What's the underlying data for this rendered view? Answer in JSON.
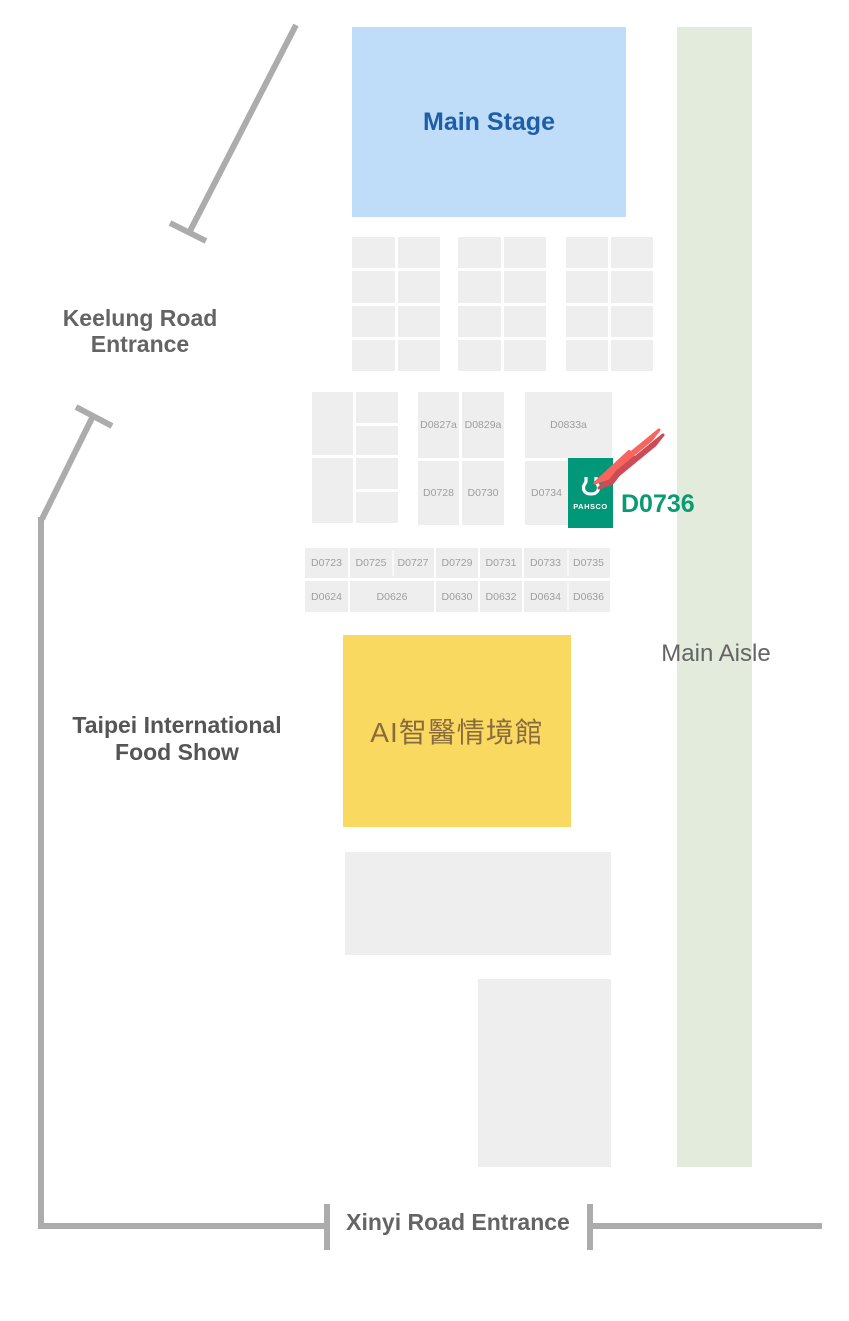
{
  "stage": {
    "label": "Main Stage"
  },
  "aisle": {
    "label": "Main Aisle"
  },
  "entrances": {
    "keelung_line1": "Keelung Road",
    "keelung_line2": "Entrance",
    "xinyi": "Xinyi Road Entrance"
  },
  "areas": {
    "food_show_line1": "Taipei International",
    "food_show_line2": "Food Show",
    "pavilion": "AI智醫情境館"
  },
  "booths": {
    "middle_top": [
      "D0827a",
      "D0829a",
      "D0833a"
    ],
    "middle_bottom": [
      "D0728",
      "D0730",
      "D0734"
    ],
    "row1": [
      "D0723",
      "D0725",
      "D0727",
      "D0729",
      "D0731",
      "D0733",
      "D0735"
    ],
    "row2": [
      "D0624",
      "D0626",
      "D0630",
      "D0632",
      "D0634",
      "D0636"
    ]
  },
  "highlight": {
    "exhibitor": "PAHSCO",
    "booth": "D0736"
  },
  "colors": {
    "stage_fill": "#BFDCF8",
    "stage_text": "#1E5EA8",
    "aisle_fill": "#E3ECDC",
    "booth_fill": "#EEEEEE",
    "booth_text": "#9E9E9E",
    "pavilion_fill": "#F9D95F",
    "pavilion_text": "#8A6B3F",
    "brand_green": "#009878",
    "arrow_red": "#F8655F",
    "arrow_shadow": "#CC4B55",
    "wall_gray": "#ACACAC",
    "label_gray": "#646464"
  }
}
